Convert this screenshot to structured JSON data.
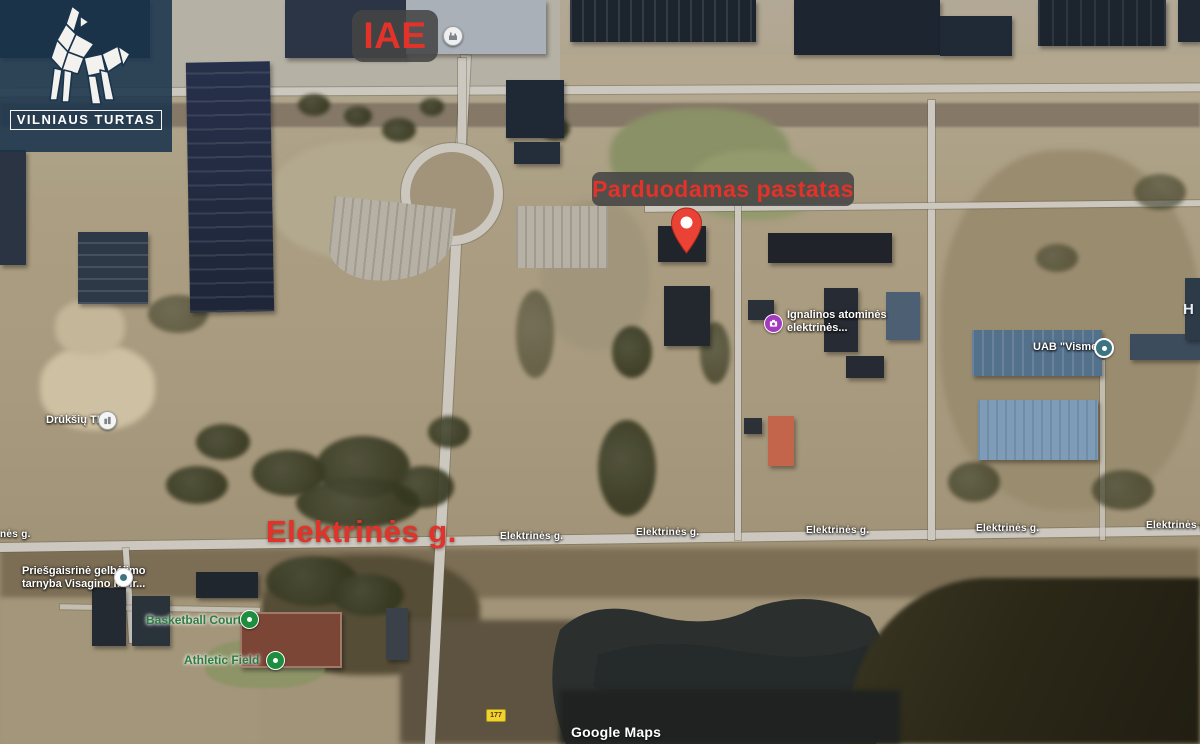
{
  "brand": {
    "name": "VILNIAUS TURTAS",
    "icon": "origami-wolf-icon",
    "bg_color": "#1a344c"
  },
  "callouts": {
    "iae": "IAE",
    "for_sale": "Parduodamas pastatas",
    "street_big": "Elektrinės g.",
    "accent_red": "#e23229",
    "box_bg": "#444444"
  },
  "streets": [
    "nės g.",
    "Elektrinės g.",
    "Elektrinės g.",
    "Elektrinės g.",
    "Elektrinės g.",
    "Elektrinės g."
  ],
  "pois": {
    "ignalinos": {
      "line1": "Ignalinos atominės",
      "line2": "elektrinės...",
      "icon": "camera-icon",
      "color": "#a43bbf"
    },
    "vismeta": {
      "label": "UAB \"Vismeta\"",
      "icon": "poi-dot-icon",
      "color": "#3e7381"
    },
    "druksiu": {
      "label": "Drūkšių TP",
      "icon": "building-icon",
      "color": "#ffffff"
    },
    "fire": {
      "line1": "Priešgaisrinė gelbėjimo",
      "line2": "tarnyba Visagino m. ir...",
      "icon": "poi-dot-icon",
      "color": "#3e7381"
    },
    "basketball": {
      "label": "Basketball Court",
      "icon": "leisure-icon",
      "color": "#1e8e3e"
    },
    "athletic": {
      "label": "Athletic Field",
      "icon": "leisure-icon",
      "color": "#1e8e3e"
    }
  },
  "marker": {
    "name": "sale-location-pin",
    "color": "#ea4335"
  },
  "road_badge": "177",
  "edge_label": "H",
  "attribution": "Google Maps"
}
